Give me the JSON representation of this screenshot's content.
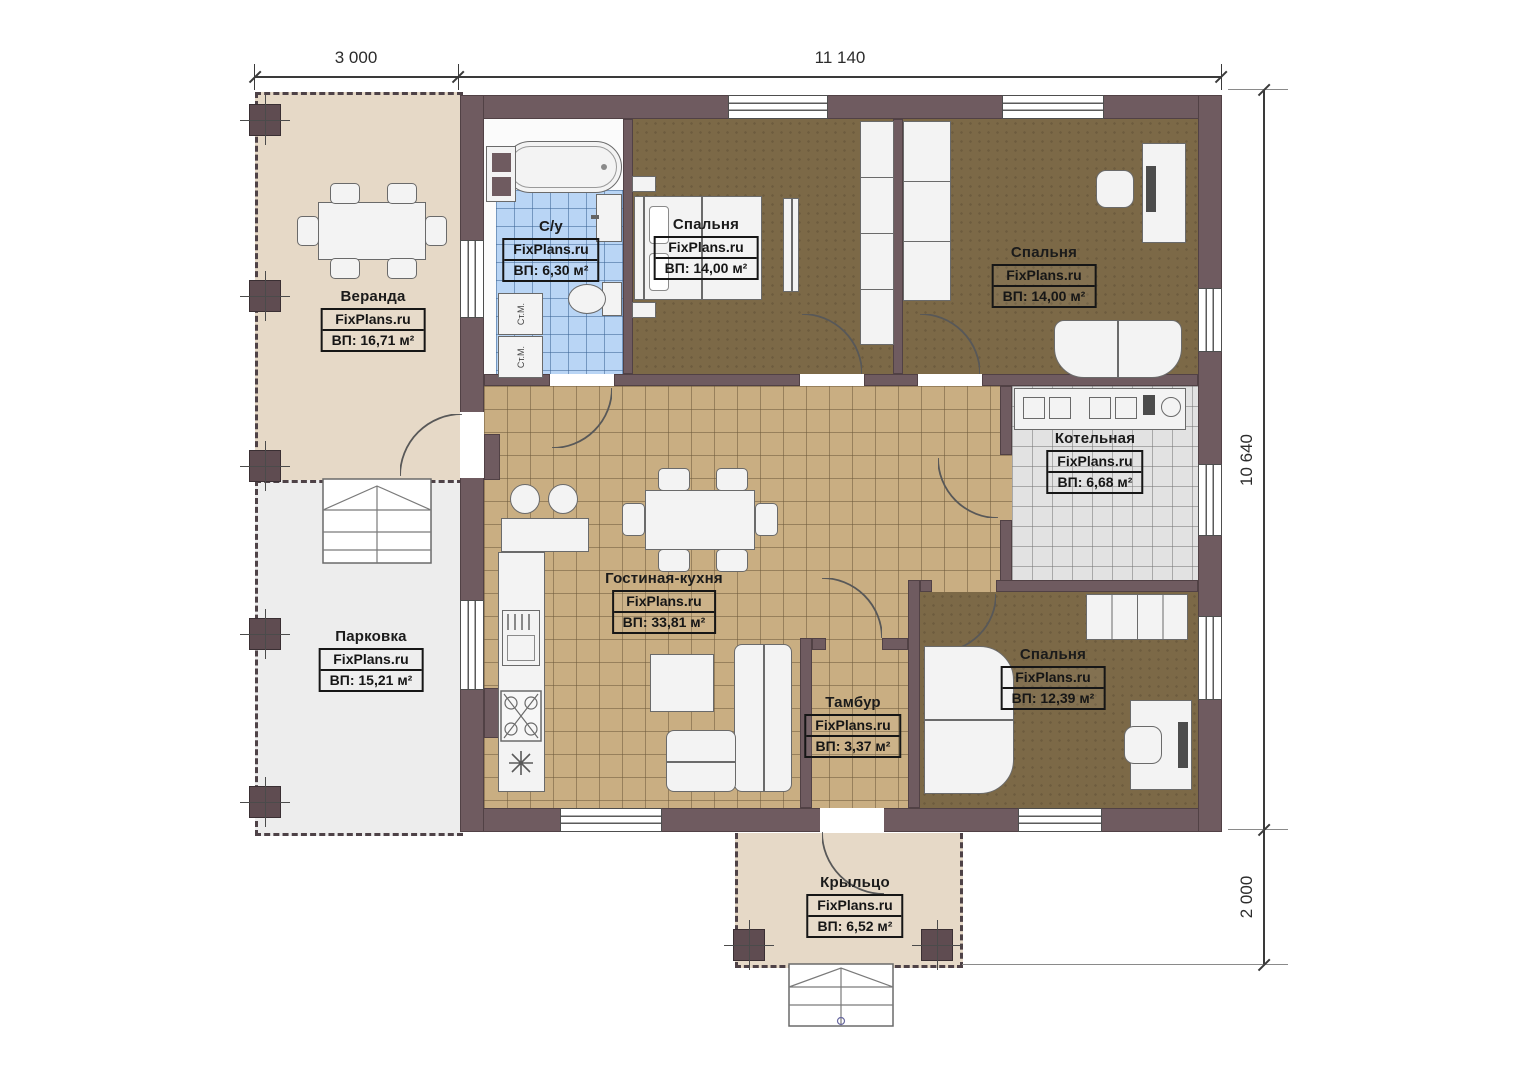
{
  "watermark": "FixPlans.ru",
  "dimensions": {
    "top": [
      {
        "label": "3 000"
      },
      {
        "label": "11 140"
      }
    ],
    "right": [
      {
        "label": "10 640"
      },
      {
        "label": "2 000"
      }
    ]
  },
  "labels": {
    "washer": "Ст.М."
  },
  "rooms": [
    {
      "name": "Веранда",
      "area": "ВП: 16,71 м²"
    },
    {
      "name": "С/у",
      "area": "ВП: 6,30 м²"
    },
    {
      "name": "Спальня",
      "area": "ВП: 14,00 м²"
    },
    {
      "name": "Спальня",
      "area": "ВП: 14,00 м²"
    },
    {
      "name": "Котельная",
      "area": "ВП: 6,68 м²"
    },
    {
      "name": "Гостиная-кухня",
      "area": "ВП: 33,81 м²"
    },
    {
      "name": "Парковка",
      "area": "ВП: 15,21 м²"
    },
    {
      "name": "Тамбур",
      "area": "ВП: 3,37 м²"
    },
    {
      "name": "Спальня",
      "area": "ВП: 12,39 м²"
    },
    {
      "name": "Крыльцо",
      "area": "ВП: 6,52 м²"
    }
  ],
  "colors": {
    "wall": "#6f5b60",
    "living_floor": "#c9ae82",
    "bedroom_floor": "#7c6947",
    "bath_floor": "#b9d5f5",
    "boiler_floor": "#e2e2e2",
    "veranda_floor": "#e6d9c7",
    "parking_floor": "#ededed"
  }
}
